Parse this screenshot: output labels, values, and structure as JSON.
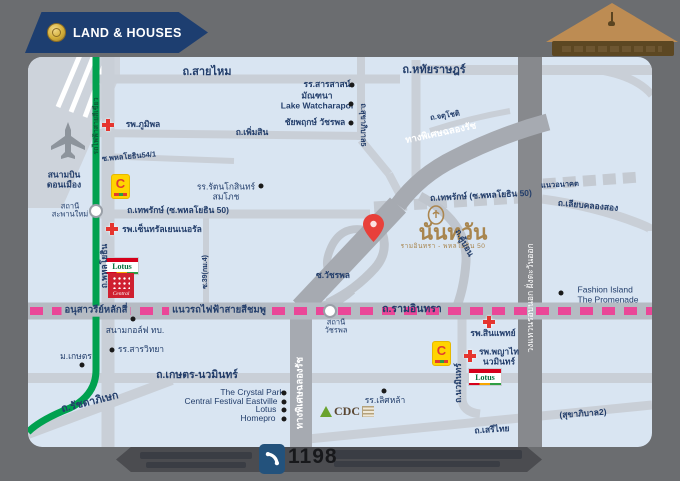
{
  "branding": {
    "logo_text": "LAND & HOUSES",
    "project_name": "นันทวัน",
    "project_subtitle": "รามอินทรา - พหลโยธิน 50"
  },
  "stores": {
    "bigc": "C",
    "lotus": "Lotus",
    "central": "Central",
    "cdc": "CDC"
  },
  "colors": {
    "pink_line": "#ea4798",
    "green_line": "#00a14f",
    "navy": "#233e6b",
    "gold": "#ab8650",
    "red_cross": "#e5352f",
    "map_bg": "#d9e5f2",
    "frame_bg": "#6b6d70"
  },
  "footer": {
    "call_center_number": "1198"
  },
  "map": {
    "labels": [
      {
        "n": "road-label-saimai",
        "t": "ถ.สายไหม",
        "x": 207,
        "y": 72,
        "c": "road-lg"
      },
      {
        "n": "road-label-hathairat",
        "t": "ถ.หทัยราษฎร์",
        "x": 434,
        "y": 70,
        "c": "road-lg"
      },
      {
        "n": "poi-sarasas-school",
        "t": "รร.สารสาสน์",
        "x": 327,
        "y": 85,
        "c": "poi-b"
      },
      {
        "n": "poi-monthana-lake-watcharapol",
        "t": "มัณฑนา\nLake Watcharapol",
        "x": 317,
        "y": 101,
        "c": "poi-b"
      },
      {
        "n": "poi-chaiyapruek-watcharapol",
        "t": "ชัยพฤกษ์ วัชรพล",
        "x": 315,
        "y": 123,
        "c": "poi-b"
      },
      {
        "n": "road-label-sukhaphiban5",
        "t": "ถ.สุขาภิบาล5",
        "x": 363,
        "y": 125,
        "r": 90,
        "c": "road-sm"
      },
      {
        "n": "road-label-permsin",
        "t": "ถ.เพิ่มสิน",
        "x": 252,
        "y": 133,
        "c": "road"
      },
      {
        "n": "road-label-phahonyothin54-1",
        "t": "ซ.พหลโยธิน54/1",
        "x": 129,
        "y": 157,
        "r": -5,
        "c": "road-sm"
      },
      {
        "n": "poi-bhumibol-hospital",
        "t": "รพ.ภูมิพล",
        "x": 143,
        "y": 125,
        "c": "poi-b"
      },
      {
        "n": "poi-don-mueang-airport",
        "t": "สนามบิน\nดอนเมือง",
        "x": 64,
        "y": 180,
        "c": "poi-b"
      },
      {
        "n": "station-label-saphan-mai",
        "t": "สถานี\nสะพานใหม่",
        "x": 70,
        "y": 211,
        "c": "poi-sm"
      },
      {
        "n": "green-line-label",
        "t": "รถไฟฟ้าสายสีเขียว",
        "x": 97,
        "y": 126,
        "r": -90,
        "c": "green-text"
      },
      {
        "n": "road-label-phahonyothin",
        "t": "ถ.พหลโยธิน",
        "x": 105,
        "y": 266,
        "r": -90,
        "c": "road"
      },
      {
        "n": "road-label-thepharak-west",
        "t": "ถ.เทพรักษ์ (ซ.พหลโยธิน 50)",
        "x": 178,
        "y": 211,
        "c": "road"
      },
      {
        "n": "poi-central-general-hospital",
        "t": "รพ.เซ็นทรัลเยนเนอรัล",
        "x": 162,
        "y": 230,
        "c": "poi-b"
      },
      {
        "n": "poi-rattanakosin-sompoch-school",
        "t": "รร.รัตนโกสินทร์\nสมโภช",
        "x": 226,
        "y": 192,
        "c": "poi"
      },
      {
        "n": "road-label-thepharak-east",
        "t": "ถ.เทพรักษ์ (ซ.พหลโยธิน 50)",
        "x": 481,
        "y": 196,
        "r": -3,
        "c": "road"
      },
      {
        "n": "road-label-future-alignment",
        "t": "แนวอนาคต",
        "x": 560,
        "y": 185,
        "r": -3,
        "c": "road-sm"
      },
      {
        "n": "road-label-liap-khlong-song",
        "t": "ถ.เลียบคลองสอง",
        "x": 588,
        "y": 206,
        "r": 5,
        "c": "road"
      },
      {
        "n": "road-label-chatuchot",
        "t": "ถ.จตุโชติ",
        "x": 445,
        "y": 116,
        "r": -9,
        "c": "road-sm"
      },
      {
        "n": "expressway-chalong-rat-label",
        "t": "ทางพิเศษฉลองรัช",
        "x": 441,
        "y": 134,
        "r": -12,
        "c": "white-road"
      },
      {
        "n": "road-label-soi39-km4",
        "t": "ซ.39(กม.4)",
        "x": 206,
        "y": 272,
        "r": -90,
        "c": "road-xs"
      },
      {
        "n": "road-label-soi-watcharapol",
        "t": "ซ.วัชรพล",
        "x": 333,
        "y": 276,
        "c": "road"
      },
      {
        "n": "road-label-khubon",
        "t": "ถ.คู้บอน",
        "x": 464,
        "y": 243,
        "r": 62,
        "c": "road"
      },
      {
        "n": "ring-road-label",
        "t": "วงแหวนรอบนอก ฝั่งตะวันออก",
        "x": 531,
        "y": 298,
        "r": -90,
        "c": "white-road-sm"
      },
      {
        "n": "pink-line-label-anusawari-laksi",
        "t": "อนุสาวรีย์หลักสี่",
        "x": 96,
        "y": 311,
        "c": "pink-cap"
      },
      {
        "n": "pink-line-label",
        "t": "แนวรถไฟฟ้าสายสีชมพู",
        "x": 219,
        "y": 311,
        "c": "pink-cap"
      },
      {
        "n": "road-label-ramintra",
        "t": "ถ.รามอินทรา",
        "x": 412,
        "y": 310,
        "c": "road-md"
      },
      {
        "n": "station-label-watcharapol",
        "t": "สถานี\nวัชรพล",
        "x": 336,
        "y": 327,
        "c": "poi-sm"
      },
      {
        "n": "poi-fashion-island",
        "t": "Fashion Island\nThe Promenade",
        "x": 608,
        "y": 295,
        "c": "poi-latin"
      },
      {
        "n": "poi-synphaet-hospital",
        "t": "รพ.สินแพทย์",
        "x": 493,
        "y": 334,
        "c": "poi-b"
      },
      {
        "n": "poi-army-golf-course",
        "t": "สนามกอล์ฟ ทบ.",
        "x": 135,
        "y": 331,
        "c": "poi"
      },
      {
        "n": "poi-sanwittaya-school",
        "t": "รร.สารวิทยา",
        "x": 141,
        "y": 350,
        "c": "poi"
      },
      {
        "n": "poi-kasetsart-university",
        "t": "ม.เกษตร",
        "x": 76,
        "y": 357,
        "c": "poi"
      },
      {
        "n": "road-label-ratchadaphisek",
        "t": "ถ.รัชดาภิเษก",
        "x": 90,
        "y": 403,
        "r": -14,
        "c": "road-md"
      },
      {
        "n": "road-label-kaset-nawamin",
        "t": "ถ.เกษตร-นวมินทร์",
        "x": 197,
        "y": 376,
        "c": "road-md"
      },
      {
        "n": "poi-crystal-park",
        "t": "The Crystal Park",
        "x": 252,
        "y": 393,
        "c": "poi-latin-r"
      },
      {
        "n": "poi-central-festival-eastville",
        "t": "Central Festival Eastville",
        "x": 231,
        "y": 402,
        "c": "poi-latin-r"
      },
      {
        "n": "poi-lotus-kaset-nawamin",
        "t": "Lotus",
        "x": 266,
        "y": 410,
        "c": "poi-latin-r"
      },
      {
        "n": "poi-homepro",
        "t": "Homepro",
        "x": 258,
        "y": 419,
        "c": "poi-latin-r"
      },
      {
        "n": "expressway-chalong-rat-label-vertical",
        "t": "ทางพิเศษฉลองรัช",
        "x": 301,
        "y": 393,
        "r": -90,
        "c": "white-road"
      },
      {
        "n": "poi-lertlah-school",
        "t": "รร.เลิศหล้า",
        "x": 385,
        "y": 401,
        "c": "poi"
      },
      {
        "n": "poi-phyathai-nawamin-hospital",
        "t": "รพ.พญาไท\nนวมินทร์",
        "x": 499,
        "y": 357,
        "c": "poi-b"
      },
      {
        "n": "road-label-nawamin",
        "t": "ถ.นวมินทร์",
        "x": 459,
        "y": 383,
        "r": -90,
        "c": "road"
      },
      {
        "n": "road-label-sukhaphiban2",
        "t": "(สุขาภิบาล2)",
        "x": 583,
        "y": 414,
        "r": -4,
        "c": "road"
      },
      {
        "n": "road-label-serithai",
        "t": "ถ.เสรีไทย",
        "x": 492,
        "y": 430,
        "r": -4,
        "c": "road"
      }
    ],
    "dots": [
      [
        352,
        85
      ],
      [
        351,
        104
      ],
      [
        351,
        123
      ],
      [
        261,
        186
      ],
      [
        561,
        293
      ],
      [
        133,
        319
      ],
      [
        112,
        350
      ],
      [
        82,
        365
      ],
      [
        284,
        393
      ],
      [
        284,
        402
      ],
      [
        284,
        410
      ],
      [
        284,
        419
      ],
      [
        384,
        391
      ]
    ],
    "crosses": [
      [
        108,
        125
      ],
      [
        112,
        229
      ],
      [
        489,
        322
      ],
      [
        470,
        356
      ]
    ],
    "stations": [
      {
        "x": 96,
        "y": 211
      },
      {
        "x": 330,
        "y": 311
      }
    ]
  }
}
